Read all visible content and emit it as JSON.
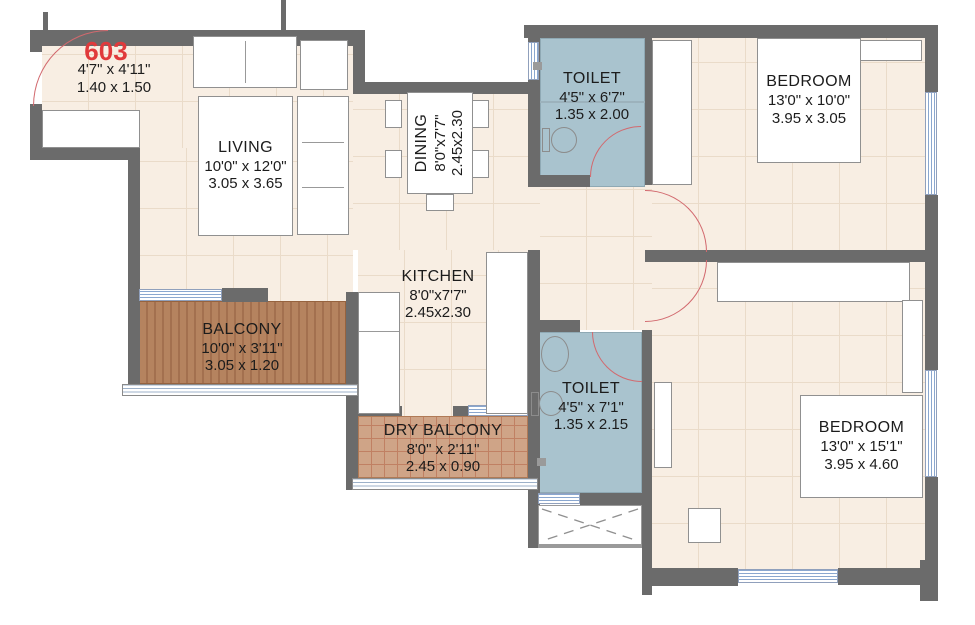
{
  "unit": {
    "number": "603",
    "dims_ft": "4'7\" x 4'11\"",
    "dims_m": "1.40 x 1.50"
  },
  "rooms": {
    "living": {
      "name": "LIVING",
      "dims_ft": "10'0\" x 12'0\"",
      "dims_m": "3.05 x 3.65"
    },
    "dining": {
      "name": "DINING",
      "dims_ft": "8'0\"x7'7\"",
      "dims_m": "2.45x2.30"
    },
    "kitchen": {
      "name": "KITCHEN",
      "dims_ft": "8'0\"x7'7\"",
      "dims_m": "2.45x2.30"
    },
    "balcony": {
      "name": "BALCONY",
      "dims_ft": "10'0\" x 3'11\"",
      "dims_m": "3.05 x 1.20"
    },
    "dry_balcony": {
      "name": "DRY BALCONY",
      "dims_ft": "8'0\" x 2'11\"",
      "dims_m": "2.45 x 0.90"
    },
    "toilet_top": {
      "name": "TOILET",
      "dims_ft": "4'5\" x 6'7\"",
      "dims_m": "1.35 x 2.00"
    },
    "bedroom_top": {
      "name": "BEDROOM",
      "dims_ft": "13'0\" x 10'0\"",
      "dims_m": "3.95 x 3.05"
    },
    "toilet_bottom": {
      "name": "TOILET",
      "dims_ft": "4'5\" x 7'1\"",
      "dims_m": "1.35 x 2.15"
    },
    "bedroom_bottom": {
      "name": "BEDROOM",
      "dims_ft": "13'0\" x 15'1\"",
      "dims_m": "3.95 x 4.60"
    }
  },
  "colors": {
    "wall": "#6b6b6b",
    "floor": "#f8eee3",
    "floor_line": "#eadbc9",
    "toilet": "#a9c3ce",
    "balcony": "#b5835f",
    "balcony_stripe": "#a3704f",
    "dry": "#cfa487",
    "dry_line": "#c08063",
    "arc": "#d2696e",
    "win": "#8aa7cf",
    "red": "#e03a3c",
    "text": "#1c1c1c"
  }
}
